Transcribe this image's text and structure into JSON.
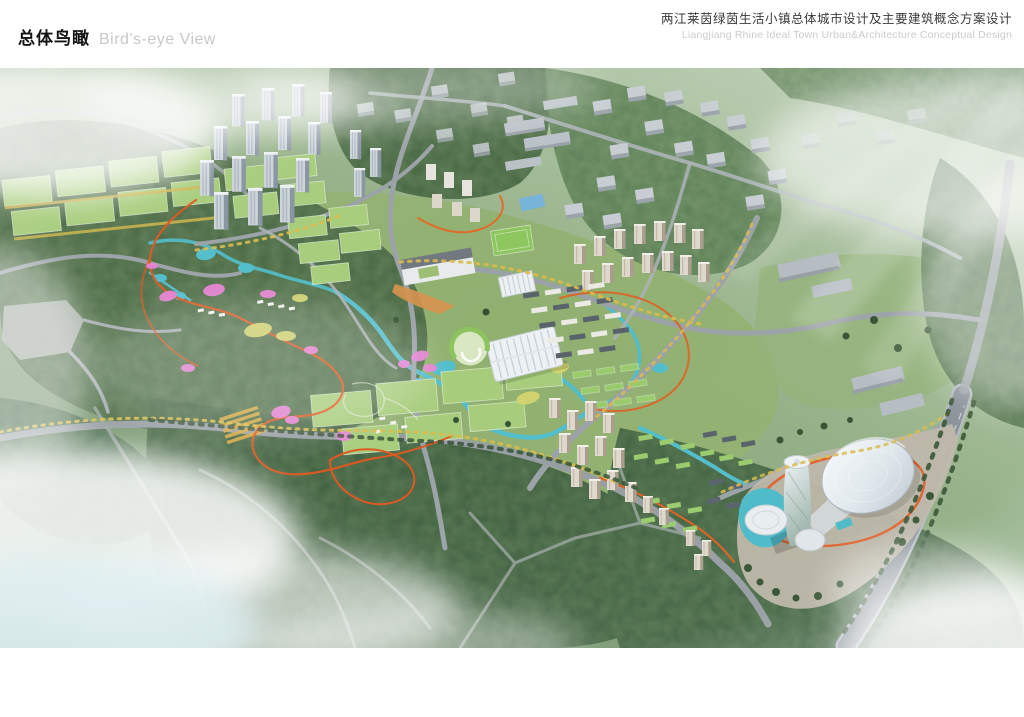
{
  "header": {
    "section_title_zh": "总体鸟瞰",
    "section_title_en": "Bird's-eye View",
    "project_title_zh": "两江莱茵绿茵生活小镇总体城市设计及主要建筑概念方案设计",
    "project_title_en": "Liangjiang Rhine Ideal Town Urban&Architecture Conceptual Design"
  },
  "rendering": {
    "description": "Aerial bird's-eye rendering of the master plan: central forest park with colorful garden paths, rows of sports fields, residential tower clusters, a ribbed greenhouse hall, green-roofed housing courts, and a white domed landmark with a twisting tower at the southeast gateway, all set in forested hills with roads and drifting clouds.",
    "palette": {
      "forest_green": "#3f5d3b",
      "lawn_green": "#9cba77",
      "field_green": "#a6cc7a",
      "water_teal": "#4fbcca",
      "path_orange": "#e0561c",
      "garden_magenta": "#ea7fd6",
      "tree_yellow": "#d9ba4a",
      "road_gray": "#9aa1a6",
      "building_gray": "#c3ccd4",
      "dome_white": "#eef3f6",
      "fog_white": "#ffffff"
    }
  }
}
